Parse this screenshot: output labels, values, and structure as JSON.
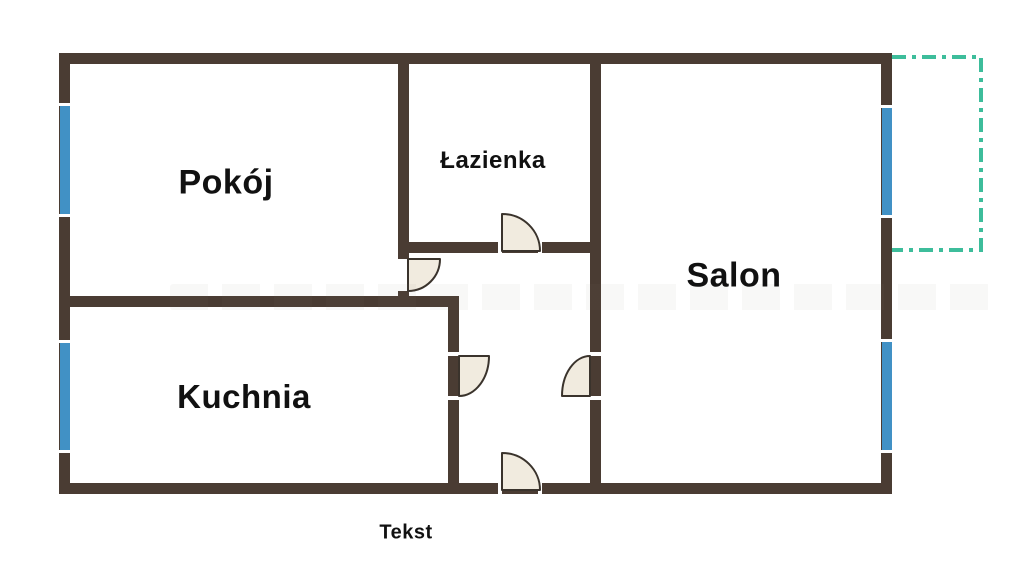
{
  "floorplan": {
    "rooms": [
      {
        "id": "pokoj",
        "label": "Pokój"
      },
      {
        "id": "lazienka",
        "label": "Łazienka"
      },
      {
        "id": "salon",
        "label": "Salon"
      },
      {
        "id": "kuchnia",
        "label": "Kuchnia"
      }
    ],
    "caption": "Tekst",
    "features": {
      "windows": 4,
      "doors": 5,
      "balcony": "dashed outline at right side"
    },
    "colors": {
      "wall": "#4a3c33",
      "window": "#4191c5",
      "balcony": "#3dbd9b",
      "door_fill": "#f1ebdf",
      "door_stroke": "#3a332c",
      "label_text": "#111111",
      "background": "#ffffff"
    }
  }
}
